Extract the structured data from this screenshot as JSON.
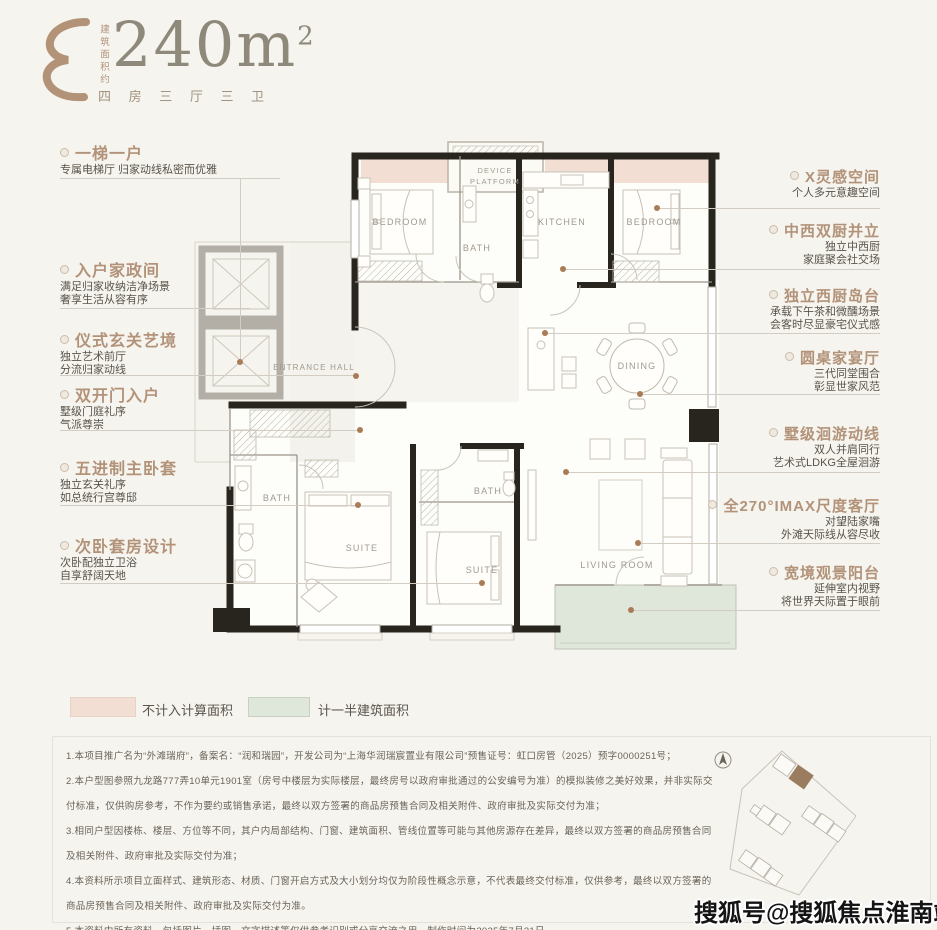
{
  "header": {
    "area_label_vertical": "建筑面积约",
    "area_value": "240m",
    "area_sup": "2",
    "layout_spec": "四 房 三 厅 三 卫"
  },
  "features_left": [
    {
      "title": "一梯一户",
      "lines": [
        "专属电梯厅 归家动线私密而优雅"
      ]
    },
    {
      "title": "入户家政间",
      "lines": [
        "满足归家收纳洁净场景",
        "奢享生活从容有序"
      ]
    },
    {
      "title": "仪式玄关艺境",
      "lines": [
        "独立艺术前厅",
        "分流归家动线"
      ]
    },
    {
      "title": "双开门入户",
      "lines": [
        "墅级门庭礼序",
        "气派尊崇"
      ]
    },
    {
      "title": "五进制主卧套",
      "lines": [
        "独立玄关礼序",
        "如总统行宫尊邸"
      ]
    },
    {
      "title": "次卧套房设计",
      "lines": [
        "次卧配独立卫浴",
        "自享舒阔天地"
      ]
    }
  ],
  "features_right": [
    {
      "title": "X灵感空间",
      "lines": [
        "个人多元意趣空间"
      ]
    },
    {
      "title": "中西双厨并立",
      "lines": [
        "独立中西厨",
        "家庭聚会社交场"
      ]
    },
    {
      "title": "独立西厨岛台",
      "lines": [
        "承载下午茶和微醺场景",
        "会客时尽显豪宅仪式感"
      ]
    },
    {
      "title": "圆桌家宴厅",
      "lines": [
        "三代同堂围合",
        "彰显世家风范"
      ]
    },
    {
      "title": "墅级洄游动线",
      "lines": [
        "双人并肩同行",
        "艺术式LDKG全屋洄游"
      ]
    },
    {
      "title": "全270°IMAX尺度客厅",
      "lines": [
        "对望陆家嘴",
        "外滩天际线从容尽收"
      ]
    },
    {
      "title": "宽境观景阳台",
      "lines": [
        "延伸室内视野",
        "将世界天际置于眼前"
      ]
    }
  ],
  "floorplan": {
    "rooms": {
      "bedroom_left": "BEDROOM",
      "device_platform_line1": "DEVICE",
      "device_platform_line2": "PLATFORM",
      "bath_top": "BATH",
      "kitchen": "KITCHEN",
      "bedroom_right": "BEDROOM",
      "entrance_hall": "ENTRANCE HALL",
      "bath_left": "BATH",
      "suite_left": "SUITE",
      "bath_inner": "BATH",
      "suite_right": "SUITE",
      "dining": "DINING",
      "living_room": "LIVING ROOM"
    }
  },
  "legend": [
    {
      "label": "不计入计算面积",
      "color": "#f3ded3"
    },
    {
      "label": "计一半建筑面积",
      "color": "#dfe6da"
    }
  ],
  "disclaimer": [
    "1.本项目推广名为“外滩瑞府”，备案名：“润和瑞园”，开发公司为“上海华润瑞宸置业有限公司”预售证号：虹口房管（2025）预字0000251号；",
    "2.本户型图参照九龙路777弄10单元1901室（房号中楼层为实际楼层，最终房号以政府审批通过的公安编号为准）的模拟装修之美好效果，并非实际交付标准，仅供购房参考，不作为要约或销售承诺，最终以双方签署的商品房预售合同及相关附件、政府审批及实际交付为准；",
    "3.相同户型因楼栋、楼层、方位等不同，其户内局部结构、门窗、建筑面积、管线位置等可能与其他房源存在差异，最终以双方签署的商品房预售合同及相关附件、政府审批及实际交付为准；",
    "4.本资料所示项目立面样式、建筑形态、材质、门窗开启方式及大小划分均仅为阶段性概念示意，不代表最终交付标准，仅供参考，最终以双方签署的商品房预售合同及相关附件、政府审批及实际交付为准。",
    "5.本资料中所有资料，包括图片、插图、文字描述等仅供参考识别或分享交流之用，制作时间为2025年7月31日。"
  ],
  "watermark": "搜狐号@搜狐焦点淮南站",
  "colors": {
    "accent_tan": "#b2937a",
    "uncounted_area_pink": "#f3ded3",
    "half_area_green": "#dfe6da",
    "wall_black": "#28251f",
    "background": "#f6f4ee"
  }
}
